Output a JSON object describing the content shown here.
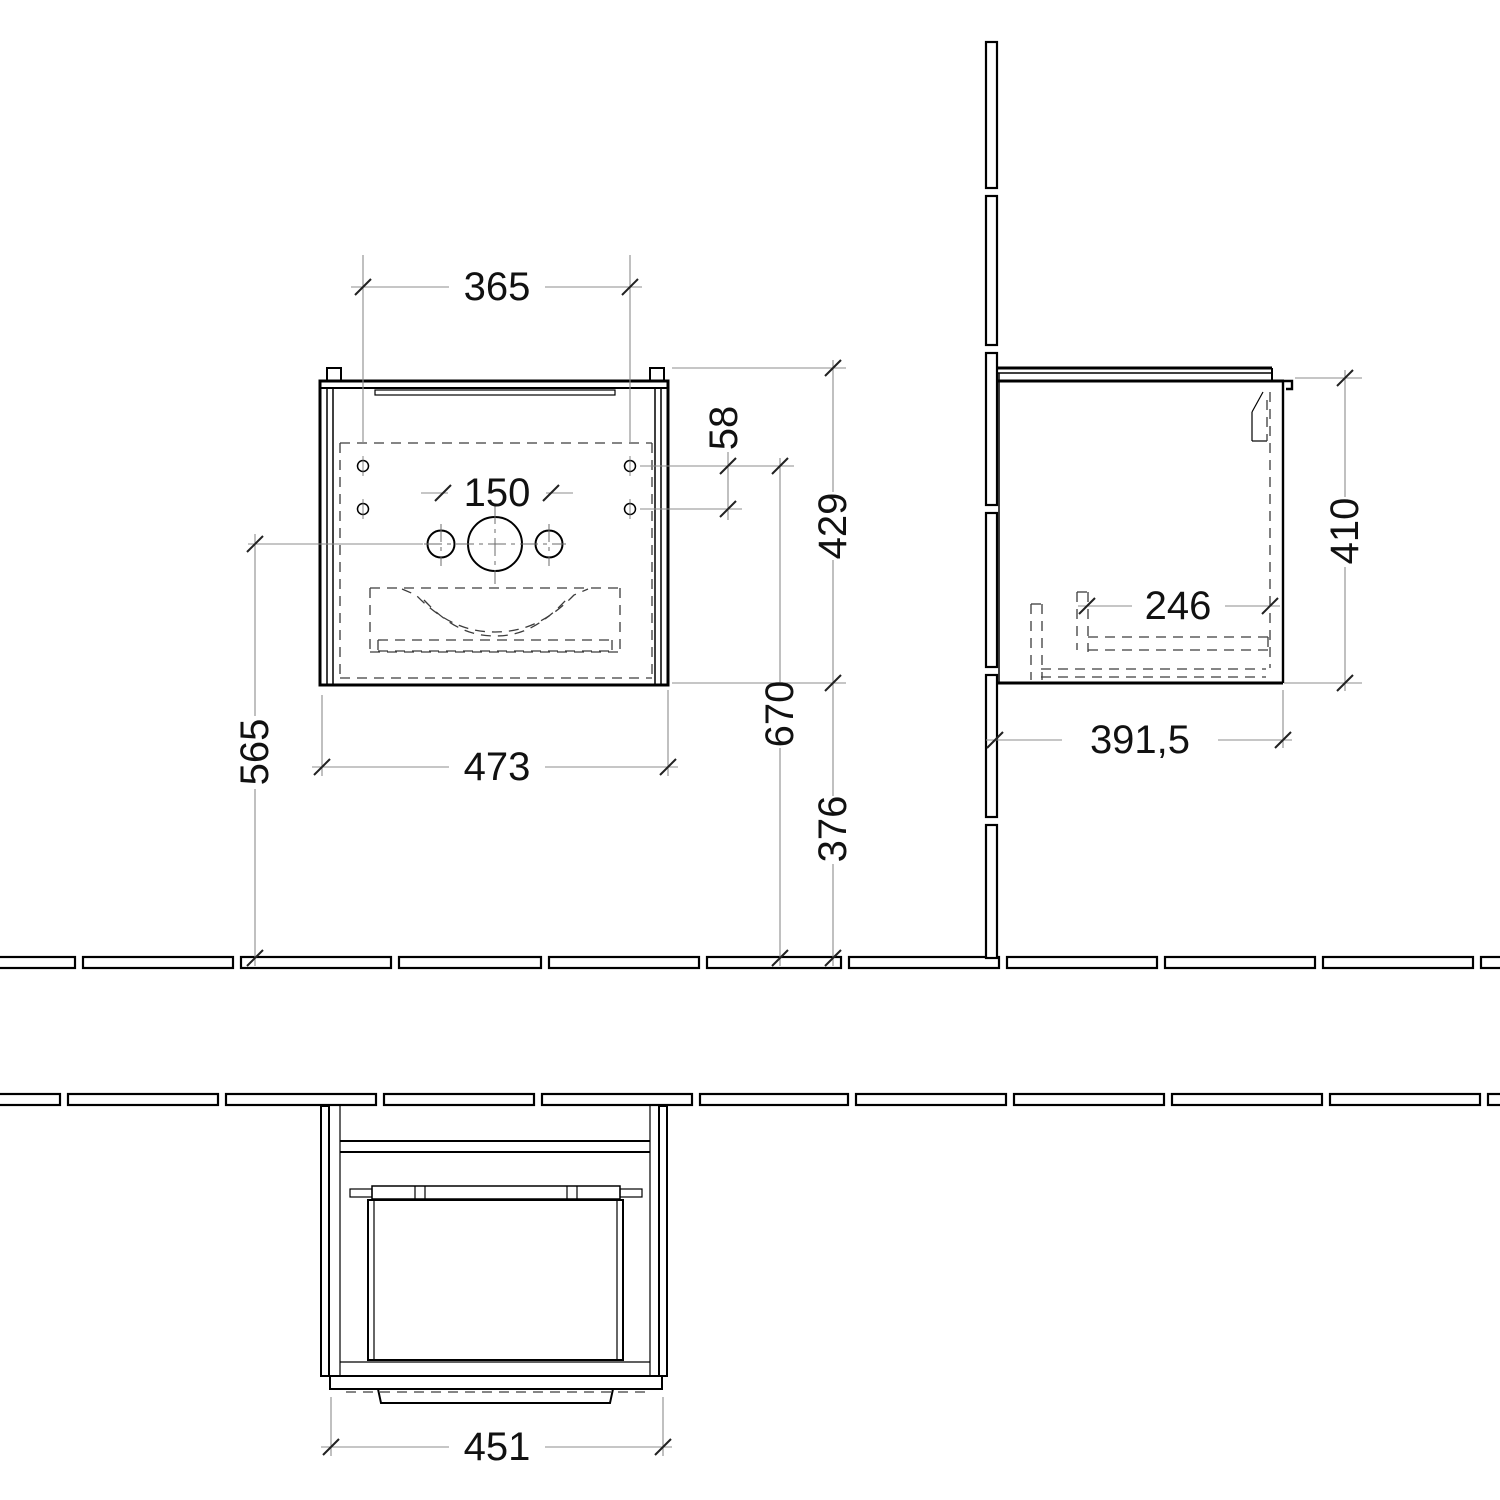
{
  "drawing": {
    "kind": "technical-drawing",
    "subject": "wall-mounted bathroom vanity unit - front, side and plan views",
    "background_color": "#ffffff",
    "line_color": "#000000",
    "dim_line_color": "#8c8c8c",
    "text_color": "#111111"
  },
  "dimensions": {
    "front_view": {
      "mount_hole_spacing": "365",
      "row_spacing": "58",
      "tap_hole_spacing": "150",
      "cabinet_height": "429",
      "cabinet_width": "473",
      "center_height": "565",
      "hole_height": "670",
      "clearance_height": "376"
    },
    "side_view": {
      "inner_depth": "246",
      "height": "410",
      "depth": "391,5"
    },
    "plan_view": {
      "front_width": "451"
    }
  }
}
